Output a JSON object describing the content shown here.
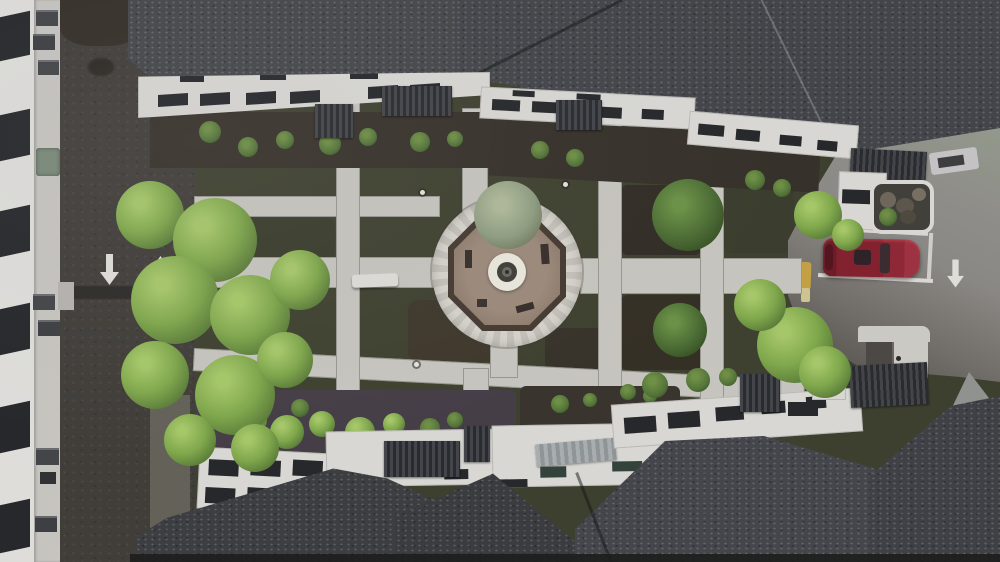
{
  "meta": {
    "title": "Aerial courtyard photograph",
    "description": "Top-down drone photo of an apartment complex: central courtyard with octagonal gazebo plaza and round fountain, concrete path grid over lawns, large trees, perimeter road with painted direction arrows, side parking lot with one dark-red car, dark shingled roofs and white facades with window bands and ribbed entry awnings.",
    "text_content": "none — the photograph contains no readable text"
  },
  "markings": {
    "road_arrow_left": "down",
    "road_arrow_right": "up",
    "parking_arrow": "down",
    "speed_bump": true,
    "yellow_curb": true
  },
  "objects": {
    "car": {
      "type": "sedan, top view",
      "color_hex": "#7e2130"
    },
    "plaza": {
      "shape": "circular paver ring with octagonal railed gazebo and central fountain"
    },
    "bench_count": 1,
    "ac_units": 7,
    "path_lights": 5
  },
  "palette": {
    "roof_shingle": "#45474b",
    "facade_white": "#d8d7d3",
    "road_asphalt": "#3e3b37",
    "parking_asphalt": "#8b8985",
    "concrete_path": "#c6c4be",
    "lawn": "#3f4130",
    "mulch": "#38322b",
    "tree_bright": "#7fa74c",
    "tree_dark": "#4a6a34",
    "gazebo_pavers": "#97857a",
    "fountain_ring": "#e9e6db",
    "yellow_curb": "#c3a044",
    "window_dark": "#26282b"
  }
}
